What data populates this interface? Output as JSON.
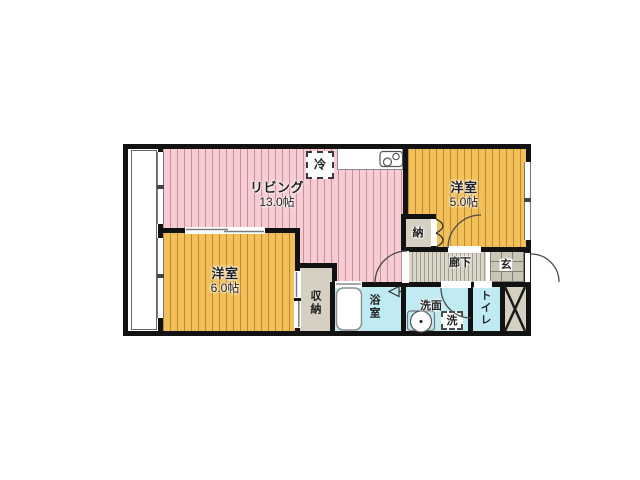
{
  "floorplan": {
    "type": "japanese-apartment-floorplan",
    "rooms": {
      "living": {
        "label": "リビング",
        "size": "13.0帖"
      },
      "bedroom_right": {
        "label": "洋室",
        "size": "5.0帖"
      },
      "bedroom_left": {
        "label": "洋室",
        "size": "6.0帖"
      },
      "storage_small": {
        "label": "納"
      },
      "closet": {
        "label": "収納"
      },
      "bathroom": {
        "label": "浴室"
      },
      "washroom": {
        "label": "洗面"
      },
      "washer": {
        "label": "洗"
      },
      "toilet": {
        "label": "トイレ"
      },
      "hallway": {
        "label": "廊下"
      },
      "entrance": {
        "label": "玄"
      },
      "refrigerator": {
        "label": "冷"
      }
    },
    "colors": {
      "wall": "#121212",
      "living_fill": "#f7ccd3",
      "living_stripe": "#c59099",
      "bedroom_fill": "#f2c05a",
      "bedroom_stripe": "#c1892a",
      "wet_area_fill": "#c0ebf3",
      "storage_fill": "#d5d0c2",
      "hallway_fill": "#d9d5c9",
      "entrance_tile": "#c9c5b7"
    }
  }
}
